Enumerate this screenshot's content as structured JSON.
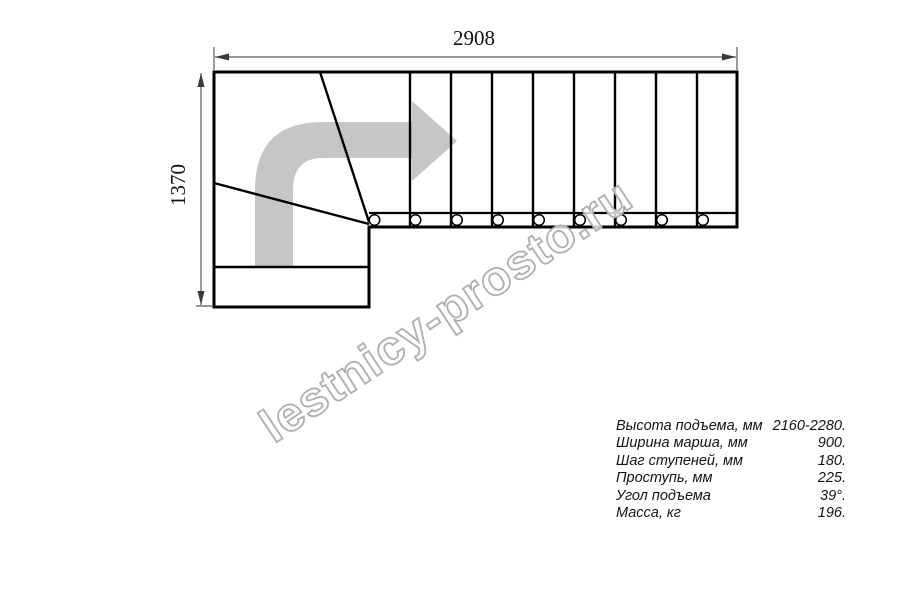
{
  "page": {
    "background": "#ffffff"
  },
  "dimensions": {
    "top": "2908",
    "left": "1370"
  },
  "watermark": {
    "text": "lestnicy-prosto.ru",
    "stroke_color": "#b0b0b0",
    "fill_color": "rgba(255,255,255,0.78)"
  },
  "drawing": {
    "type": "staircase-plan-top-view",
    "arrow_color": "#c6c6c6",
    "line_color": "#000000",
    "dim_line_color": "#5a5a5a",
    "straight_treads_count": 9,
    "winder_lines_count": 2,
    "baluster_count": 9
  },
  "specs": {
    "rows": [
      {
        "label": "Высота подъема, мм",
        "value": "2160-2280."
      },
      {
        "label": "Ширина марша, мм",
        "value": "900."
      },
      {
        "label": "Шаг ступеней, мм",
        "value": "180."
      },
      {
        "label": "Проступь, мм",
        "value": "225."
      },
      {
        "label": "Угол подъема",
        "value": "39°."
      },
      {
        "label": "Масса, кг",
        "value": "196."
      }
    ]
  }
}
